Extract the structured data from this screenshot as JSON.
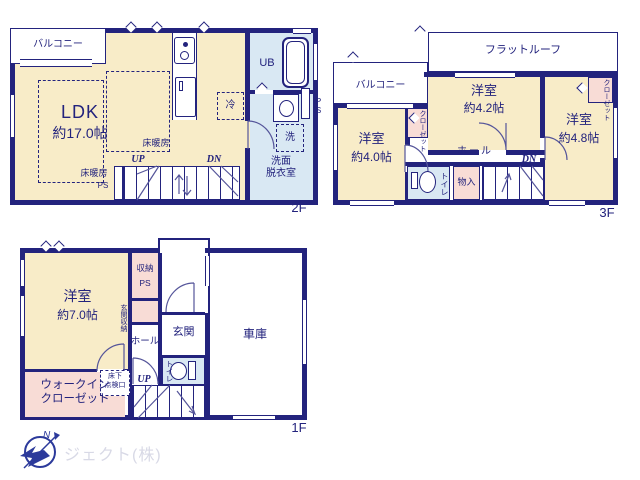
{
  "colors": {
    "wall": "#23237d",
    "room_cream": "#f8ecc8",
    "storage_pink": "#f8dcd6",
    "wet_blue": "#d9e8f3",
    "logo_text": "#d8d9e6",
    "compass_blue": "#2c3a9b"
  },
  "floor2": {
    "name": "2F",
    "balcony": "バルコニー",
    "ldk": {
      "name": "LDK",
      "size": "約17.0帖"
    },
    "heating": "床暖房",
    "up": "UP",
    "dn": "DN",
    "ps_left": "PS",
    "ps_right": "PS",
    "ub": "UB",
    "fridge": "冷",
    "washer": "洗",
    "washroom_line1": "洗面",
    "washroom_line2": "脱衣室"
  },
  "floor3": {
    "name": "3F",
    "flat_roof": "フラットルーフ",
    "balcony": "バルコニー",
    "room_a": {
      "name": "洋室",
      "size": "約4.2帖"
    },
    "room_b": {
      "name": "洋室",
      "size": "約4.8帖"
    },
    "room_c": {
      "name": "洋室",
      "size": "約4.0帖"
    },
    "closet_left": "クローゼット",
    "closet_right": "クローゼット",
    "hall": "ホール",
    "toilet": "トイレ",
    "storage": "物入",
    "dn": "DN"
  },
  "floor1": {
    "name": "1F",
    "room": {
      "name": "洋室",
      "size": "約7.0帖"
    },
    "storage": "収納",
    "ps": "PS",
    "entrance_storage": "玄関収納",
    "entrance": "玄関",
    "garage": "車庫",
    "hall": "ホール",
    "toilet": "トイレ",
    "up": "UP",
    "wic_line1": "ウォークイン",
    "wic_line2": "クローゼット",
    "hatch_line1": "床下",
    "hatch_line2": "点検口"
  },
  "logo": {
    "company": "ジェクト(株)",
    "north": "N"
  }
}
